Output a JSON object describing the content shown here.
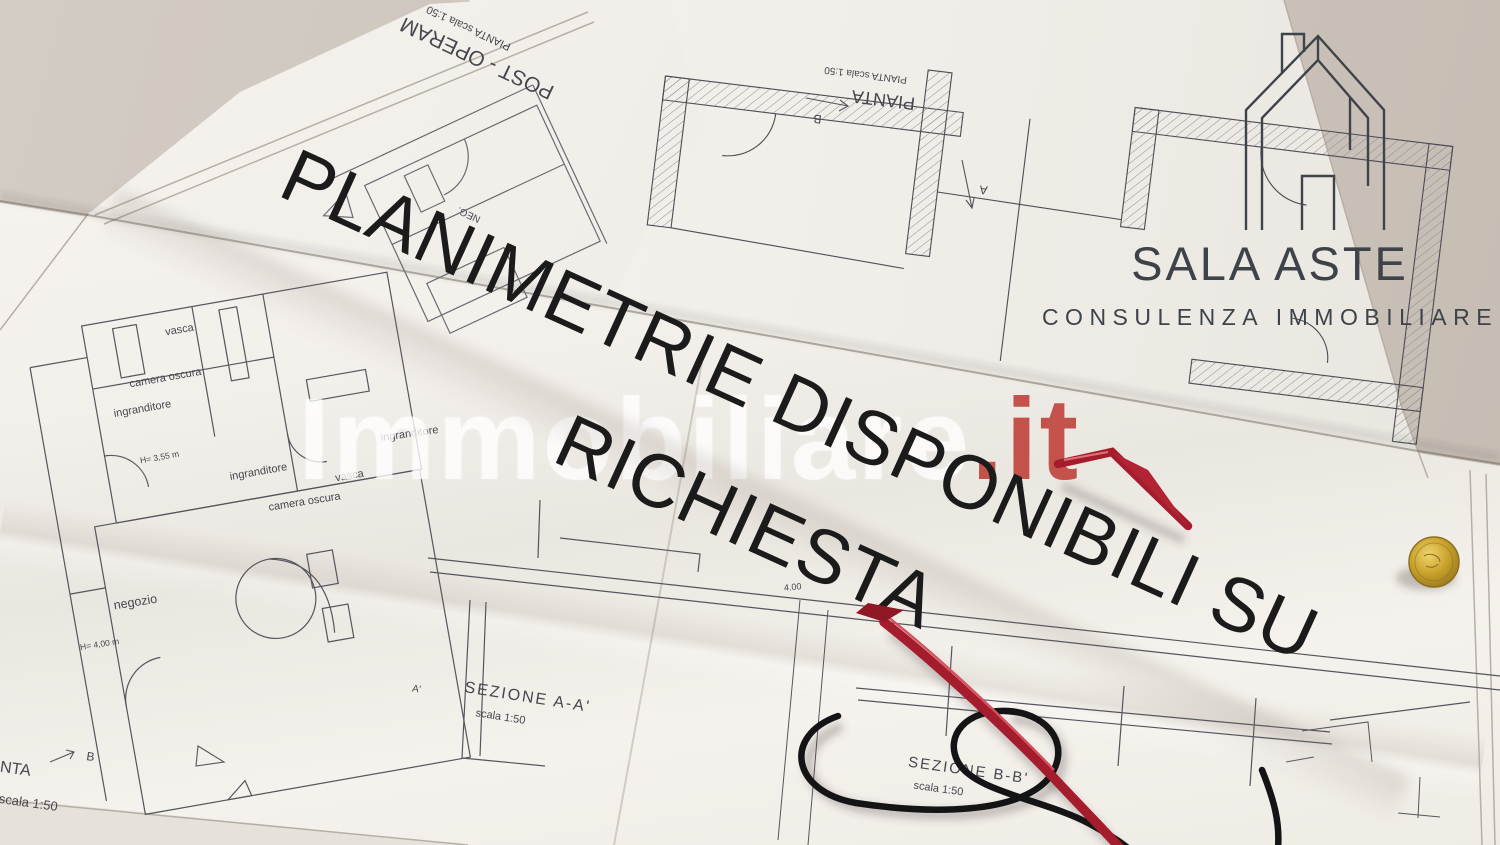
{
  "background": {
    "backdrop_color": "#ccc4bb",
    "paper_color": "#f6f3ef"
  },
  "accents": {
    "overlay_text": "#1b1b1b",
    "logo_gray": "#3e434a",
    "watermark_red": "#ba3028",
    "glasses_red": "#a51d2c",
    "cord_black": "#141417",
    "coin_gold": "#c9a22c"
  },
  "overlay": {
    "line1": "PLANIMETRIE DISPONIBILI SU",
    "line2": "RICHIESTA"
  },
  "watermark": {
    "name": "Immobiliare",
    "tld": ".it"
  },
  "logo": {
    "brand": "SALA ASTE",
    "tagline": "CONSULENZA IMMOBILIARE",
    "icon": "house-outline-icon"
  },
  "sheet_top_left": {
    "title": "POST - OPERAM",
    "scale_note": "PIANTA  scala 1:50",
    "tiny_label": "NEG."
  },
  "sheet_top_right": {
    "title": "PIANTA",
    "scale_note": "PIANTA  scala 1:50",
    "marker_a": "A",
    "marker_b": "B"
  },
  "main_plan": {
    "labels": [
      "vasca",
      "camera oscura",
      "ingranditore",
      "H= 3,55 m",
      "ingranditore",
      "vasca",
      "ingranditore",
      "camera oscura",
      "negozio",
      "H= 4,00 m"
    ],
    "plan_title": "PIANTA",
    "plan_scale": "PIANTA  scala 1:50",
    "marker_b": "B",
    "dim": "4.00",
    "section_a": {
      "title": "SEZIONE  A-A'",
      "scale": "scala 1:50",
      "marker": "A'"
    },
    "section_b": {
      "title": "SEZIONE  B-B'",
      "scale": "scala 1:50"
    }
  },
  "objects": {
    "glasses": "red-reading-glasses-with-black-cord-icon",
    "coin": "gold-coin-icon"
  }
}
